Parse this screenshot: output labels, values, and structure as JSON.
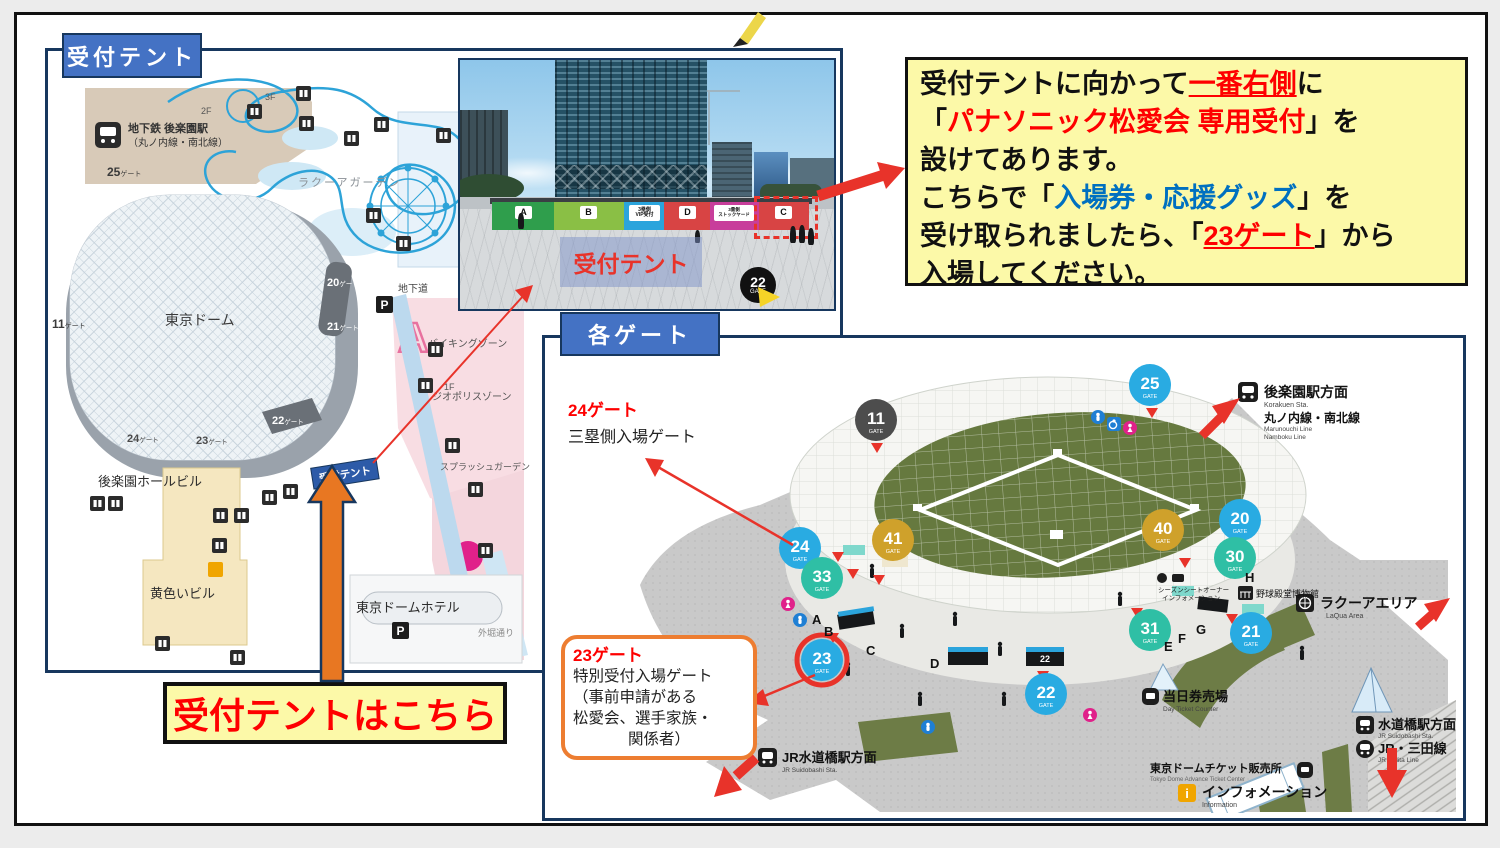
{
  "colors": {
    "accent_blue": "#4472c4",
    "panel_border": "#17375e",
    "highlight_yellow": "#fcf9a8",
    "alert_red": "#fe0000",
    "link_blue": "#0070c0",
    "orange": "#ed7d31",
    "gate_blue": "#29abe2",
    "gate_teal": "#2fbfa5",
    "gate_gold": "#cfa12b",
    "gate_dark": "#4d4d4d",
    "field_green": "#66793f"
  },
  "left_panel": {
    "header": "受付テント",
    "map": {
      "station": {
        "line1": "地下鉄 後楽園駅",
        "line2": "（丸ノ内線・南北線）"
      },
      "laqua_garden": "ラクーアガーデン",
      "dome": "東京ドーム",
      "underpass": "地下道",
      "parking": "P",
      "road": "外堀通り",
      "ride_a": "A",
      "floors": {
        "f3": "3F",
        "f2": "2F",
        "f12": "1F 2F",
        "f1": "1F"
      },
      "gates": {
        "g25": {
          "num": "25",
          "suf": "ゲート"
        },
        "g11": {
          "num": "11",
          "suf": "ゲート"
        },
        "g20": {
          "num": "20",
          "suf": "ゲート"
        },
        "g21": {
          "num": "21",
          "suf": "ゲート"
        },
        "g22": {
          "num": "22",
          "suf": "ゲート"
        },
        "g23": {
          "num": "23",
          "suf": "ゲート"
        },
        "g24": {
          "num": "24",
          "suf": "ゲート"
        }
      },
      "zones": {
        "viking": "バイキングゾーン",
        "geopolis": "ジオポリスゾーン",
        "splash": "スプラッシュガーデン"
      },
      "buildings": {
        "korakuen_hall": "後楽園ホールビル",
        "yellow_bldg": "黄色いビル",
        "dome_hotel": "東京ドームホテル"
      },
      "tent_tag": "受付テント"
    },
    "photo": {
      "tents": {
        "a": "A",
        "b": "B",
        "vip1": "3塁側",
        "vip2": "VIP受付",
        "d": "D",
        "stock1": "3塁側",
        "stock2": "ストックヤード",
        "c": "C"
      },
      "overlay": "受付テント",
      "gate22": {
        "num": "22",
        "word": "GATE"
      }
    },
    "here_box": "受付テントはこちら"
  },
  "instruction": {
    "l1a": "受付テントに向かって",
    "l1b": "一番右側",
    "l1c": "に",
    "l2a": "「",
    "l2b": "パナソニック松愛会 専用受付",
    "l2c": "」を",
    "l3": "設けてあります。",
    "l4a": "こちらで「",
    "l4b": "入場券・応援グッズ",
    "l4c": "」を",
    "l5a": "受け取られましたら、「",
    "l5b": "23ゲート",
    "l5c": "」から",
    "l6": "入場してください。"
  },
  "gates_panel": {
    "header": "各ゲート",
    "gate_word": "GATE",
    "gate24_note": {
      "title": "24ゲート",
      "desc": "三塁側入場ゲート"
    },
    "gate23_note": {
      "title": "23ゲート",
      "l1": "特別受付入場ゲート",
      "l2": "（事前申請がある",
      "l3": "松愛会、選手家族・",
      "l4": "関係者）"
    },
    "gates": {
      "g11": "11",
      "g25": "25",
      "g24": "24",
      "g33": "33",
      "g41": "41",
      "g40": "40",
      "g20": "20",
      "g30": "30",
      "g31": "31",
      "g21": "21",
      "g22": "22",
      "g23": "23"
    },
    "letters": {
      "a": "A",
      "b": "B",
      "c": "C",
      "d": "D",
      "e": "E",
      "f": "F",
      "g": "G",
      "h": "H"
    },
    "labels": {
      "korakuen_jp": "後楽園駅方面",
      "korakuen_en": "Korakuen Sta.",
      "korakuen_line_jp": "丸ノ内線・南北線",
      "korakuen_line_en1": "Marunouchi Line",
      "korakuen_line_en2": "Namboku Line",
      "laqua_jp": "ラクーアエリア",
      "laqua_en": "LaQua Area",
      "jr_suidobashi_jp": "JR水道橋駅方面",
      "jr_suidobashi_en": "JR Suidobashi Sta.",
      "suidobashi_jp": "水道橋駅方面",
      "suidobashi_en": "JR Suidobashi Sta.",
      "mita_jp": "JR・三田線",
      "mita_en": "JR・Mita Line",
      "day_ticket_jp": "当日券売場",
      "day_ticket_en": "Day Ticket Counter",
      "td_ticket_jp": "東京ドームチケット販売所",
      "td_ticket_en": "Tokyo Dome Advance Ticket Center",
      "info_jp": "インフォメーション",
      "info_en": "Information",
      "hall_of_fame": "野球殿堂博物館",
      "season_seat1": "シーズンシートオーナー",
      "season_seat2": "インフォメーション"
    }
  }
}
